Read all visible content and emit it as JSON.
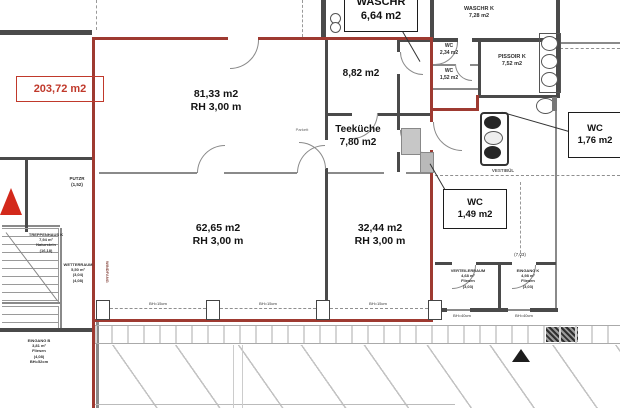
{
  "unit_area_badge": "203,72 m2",
  "rooms": {
    "hall_top": {
      "area": "81,33 m2",
      "height": "RH 3,00 m"
    },
    "room_small": {
      "area": "8,82 m2"
    },
    "teekueche": {
      "name": "Teeküche",
      "area": "7,80 m2"
    },
    "hall_bottom_left": {
      "area": "62,65 m2",
      "height": "RH 3,00 m"
    },
    "hall_bottom_right": {
      "area": "32,44 m2",
      "height": "RH 3,00 m"
    },
    "waschr_k": {
      "name": "WASCHR K",
      "area": "7,28 m2"
    },
    "wc_1": {
      "name": "WC",
      "area": "2,34 m2"
    },
    "wc_2": {
      "name": "WC",
      "area": "1,52 m2"
    },
    "pissoir_k": {
      "name": "PISSOIR K",
      "area": "7,52 m2"
    },
    "vestibuel": {
      "name": "VESTIBÜL"
    },
    "putzr": {
      "name": "PUTZR",
      "dim": "(1,52)"
    },
    "treppenhaus_k": {
      "name": "TREPPENHAUS K",
      "area": "7,94 m²",
      "floor": "Naturstein",
      "dim": "(16,18)"
    },
    "wetterraum": {
      "name": "WETTERRAUM",
      "area": "5,50 m²",
      "dim_a": "(3,04)",
      "dim_b": "(4,08)"
    },
    "windfang": {
      "name": "WINDFANG"
    },
    "eingang_b": {
      "name": "EINGANG B",
      "area": "3,81 m²",
      "floor": "Fliesen",
      "dim": "(4,08)",
      "sill": "BH=52cm"
    },
    "verteilerraum": {
      "name": "VERTEILERRAUM",
      "area": "4,68 m²",
      "floor": "Fliesen",
      "dim": "(3,03)"
    },
    "eingang_k": {
      "name": "EINGANG K",
      "area": "4,98 m²",
      "floor": "Fliesen",
      "dim": "(3,03)"
    }
  },
  "callouts": {
    "waschr": {
      "name": "WASCHR",
      "area": "6,64 m2"
    },
    "wc_right": {
      "name": "WC",
      "area": "1,76 m2"
    },
    "wc_mid": {
      "name": "WC",
      "area": "1,49 m2"
    }
  },
  "dims": {
    "front_sill": "BH=15cm",
    "entry_sill": "BH=40cm",
    "front_span": "(7,03)"
  },
  "floor_note": "Parkett",
  "colors": {
    "boundary_red": "#9e3a31",
    "badge_red": "#c0392b",
    "wall_gray": "#4a4a4a"
  }
}
